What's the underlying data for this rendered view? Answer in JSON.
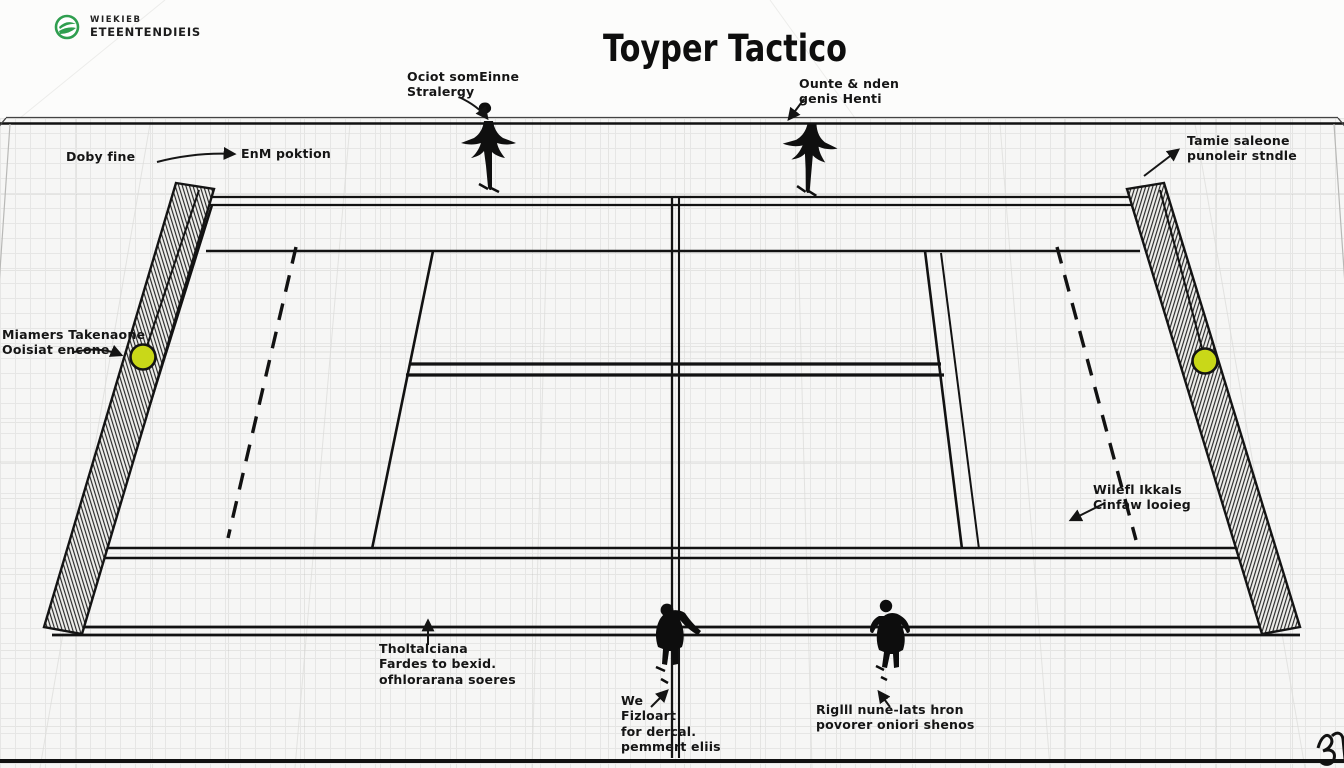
{
  "page": {
    "title": "Toyper Tactico",
    "background": "#f6f6f5"
  },
  "logo": {
    "line1": "WIEKIEB",
    "line2": "ETEENTENDIEIS",
    "accent_color": "#2f9e4f"
  },
  "labels": {
    "corner_strategy": {
      "line1": "Ociot somEinne",
      "line2": "Stralergy"
    },
    "opponent_goals": {
      "line1": "Ounte & nden",
      "line2": "genis Henti"
    },
    "baseline_left": {
      "text1": "Doby fine",
      "text2": "EnM poktion"
    },
    "top_right": {
      "line1": "Tamie saleone",
      "line2": "punoleir stndle"
    },
    "mid_left": {
      "line1": "Miamers Takenaone",
      "line2": "Ooisiat encone"
    },
    "mid_right": {
      "line1": "Wilefl Ikkals",
      "line2": "Cinfaw looieg"
    },
    "bottom_left": {
      "line1": "Tholtalciana",
      "line2": "Fardes to bexid.",
      "line3": "ofhlorarana soeres"
    },
    "bottom_center": {
      "line1": "We",
      "line2": "Fizloart",
      "line3": "for dercal.",
      "line4": "pemmert eliis"
    },
    "bottom_right": {
      "line1": "Riglll nune-lats hron",
      "line2": "povorer oniori shenos"
    }
  },
  "icons": {
    "logo_icon": "green-swoosh-ball",
    "ball_icon": "tennis-ball",
    "player_icon": "player-silhouette",
    "arrow_figure_icon": "diving-player-arrow",
    "signature_icon": "scribble-signature"
  },
  "colors": {
    "ink": "#141414",
    "ball": "#c9d818",
    "net": "#1a1a1a",
    "grid_line": "#e6e6e5"
  }
}
